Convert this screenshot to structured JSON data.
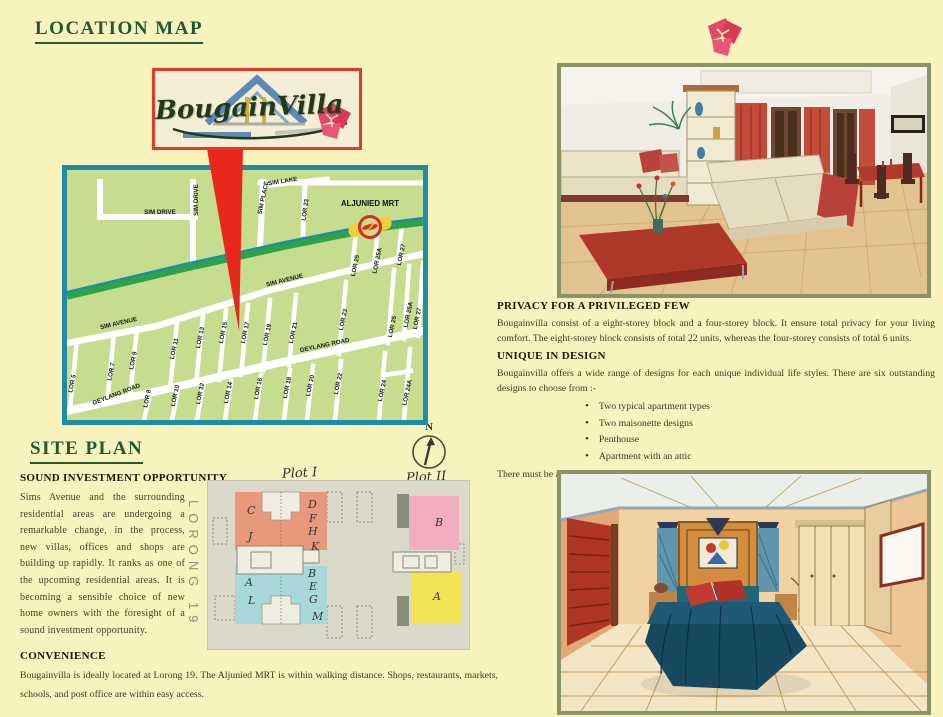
{
  "page": {
    "background": "#F8F2BC"
  },
  "colors": {
    "heading_green": "#1E5A32",
    "accent_red": "#E62B1E",
    "map_border_teal": "#1F8CA6",
    "map_bg_green": "#C6DC8F",
    "mrt_line_green": "#2EA24B",
    "frame_olive": "#8A9466",
    "body_text": "#3E3826"
  },
  "icons": {
    "flower": "bougainvillea-flower-icon",
    "compass": "north-compass-icon",
    "mrt": "mrt-station-icon",
    "pointer": "location-pointer-arrow",
    "roof": "house-roof-icon"
  },
  "location_map": {
    "title": "LOCATION MAP",
    "logo_text": "BougainVilla",
    "street_labels": [
      {
        "text": "SIM DRIVE",
        "x": 93,
        "y": 44,
        "rot": 0
      },
      {
        "text": "SIM DRIVE",
        "x": 131,
        "y": 30,
        "rot": -90
      },
      {
        "text": "SIM PLACE",
        "x": 198,
        "y": 28,
        "rot": -78
      },
      {
        "text": "SIM LAKE",
        "x": 216,
        "y": 13,
        "rot": -9
      },
      {
        "text": "LOR 23",
        "x": 240,
        "y": 40,
        "rot": -82
      },
      {
        "text": "ALJUNIED MRT",
        "x": 303,
        "y": 36,
        "rot": 0,
        "big": true
      },
      {
        "text": "LOR 25",
        "x": 290,
        "y": 96,
        "rot": -78
      },
      {
        "text": "LOR 25A",
        "x": 312,
        "y": 91,
        "rot": -78
      },
      {
        "text": "LOR 27",
        "x": 336,
        "y": 85,
        "rot": -78
      },
      {
        "text": "SIM AVENUE",
        "x": 52,
        "y": 155,
        "rot": -13
      },
      {
        "text": "SIM AVENUE",
        "x": 218,
        "y": 112,
        "rot": -14
      },
      {
        "text": "GEYLANG ROAD",
        "x": 258,
        "y": 177,
        "rot": -12
      },
      {
        "text": "GEYLANG ROAD",
        "x": 50,
        "y": 226,
        "rot": -21
      },
      {
        "text": "LOR 5",
        "x": 7,
        "y": 214,
        "rot": -78
      },
      {
        "text": "LOR 7",
        "x": 46,
        "y": 202,
        "rot": -78
      },
      {
        "text": "LOR 9",
        "x": 68,
        "y": 191,
        "rot": -78
      },
      {
        "text": "LOR 11",
        "x": 109,
        "y": 179,
        "rot": -78
      },
      {
        "text": "LOR 13",
        "x": 135,
        "y": 168,
        "rot": -78
      },
      {
        "text": "LOR 15",
        "x": 158,
        "y": 163,
        "rot": -78
      },
      {
        "text": "LOR 17",
        "x": 180,
        "y": 163,
        "rot": -78
      },
      {
        "text": "LOR 19",
        "x": 202,
        "y": 165,
        "rot": -78
      },
      {
        "text": "LOR 21",
        "x": 228,
        "y": 163,
        "rot": -78
      },
      {
        "text": "LOR 23",
        "x": 278,
        "y": 150,
        "rot": -78
      },
      {
        "text": "LOR 25",
        "x": 327,
        "y": 157,
        "rot": -78
      },
      {
        "text": "LOR 25A",
        "x": 343,
        "y": 145,
        "rot": -78
      },
      {
        "text": "LOR 27",
        "x": 352,
        "y": 149,
        "rot": -78
      },
      {
        "text": "LOR 8",
        "x": 82,
        "y": 229,
        "rot": -78
      },
      {
        "text": "LOR 10",
        "x": 110,
        "y": 226,
        "rot": -78
      },
      {
        "text": "LOR 12",
        "x": 135,
        "y": 224,
        "rot": -78
      },
      {
        "text": "LOR 14",
        "x": 163,
        "y": 223,
        "rot": -78
      },
      {
        "text": "LOR 16",
        "x": 193,
        "y": 219,
        "rot": -78
      },
      {
        "text": "LOR 18",
        "x": 222,
        "y": 218,
        "rot": -78
      },
      {
        "text": "LOR 20",
        "x": 245,
        "y": 216,
        "rot": -78
      },
      {
        "text": "LOR 22",
        "x": 273,
        "y": 214,
        "rot": -78
      },
      {
        "text": "LOR 24",
        "x": 317,
        "y": 221,
        "rot": -78
      },
      {
        "text": "LOR 24A",
        "x": 342,
        "y": 223,
        "rot": -78
      }
    ]
  },
  "site_plan": {
    "title": "SITE PLAN",
    "lorong_label": "LORONG 19",
    "plot1_label": "Plot I",
    "plot2_label": "Plot II",
    "compass_n": "N",
    "unit_letters": [
      {
        "text": "C",
        "x": 40,
        "y": 34
      },
      {
        "text": "J",
        "x": 41,
        "y": 60
      },
      {
        "text": "D",
        "x": 101,
        "y": 28
      },
      {
        "text": "F",
        "x": 102,
        "y": 42
      },
      {
        "text": "H",
        "x": 101,
        "y": 55
      },
      {
        "text": "K",
        "x": 104,
        "y": 70
      },
      {
        "text": "A",
        "x": 38,
        "y": 106
      },
      {
        "text": "L",
        "x": 41,
        "y": 124
      },
      {
        "text": "B",
        "x": 101,
        "y": 97
      },
      {
        "text": "E",
        "x": 102,
        "y": 110
      },
      {
        "text": "G",
        "x": 102,
        "y": 123
      },
      {
        "text": "M",
        "x": 105,
        "y": 140
      },
      {
        "text": "B",
        "x": 228,
        "y": 46
      },
      {
        "text": "A",
        "x": 226,
        "y": 120
      }
    ]
  },
  "sections": {
    "sound_investment": {
      "heading": "SOUND INVESTMENT OPPORTUNITY",
      "body": "Sims Avenue and the surrounding residential areas are undergoing a remarkable change, in the process, new villas, offices and shops are building up rapidly. It ranks as one of the upcoming residential areas. It is becoming a sensible choice of new home owners with the foresight of a sound investment opportunity."
    },
    "convenience": {
      "heading": "CONVENIENCE",
      "body": "Bougainvilla is ideally located at Lorong 19. The Aljunied MRT is within walking distance. Shops, restaurants, markets, schools, and post office are within easy access."
    },
    "privacy": {
      "heading": "PRIVACY FOR A PRIVILEGED FEW",
      "body": "Bougainvilla consist of a eight-storey block and a four-storey block. It ensure total privacy for your living comfort. The eight-storey block consists of total 22 units, whereas the four-storey consists of total 6 units."
    },
    "unique": {
      "heading": "UNIQUE IN DESIGN",
      "intro": "Bougainvilla offers a wide range of designs for each unique individual life styles. There are six outstanding designs to choose from :-",
      "bullets": [
        "Two typical apartment types",
        "Two maisonette designs",
        "Penthouse",
        "Apartment with an attic"
      ],
      "closing": "There must be a choice that will satisfy your unique character and living styles."
    }
  }
}
